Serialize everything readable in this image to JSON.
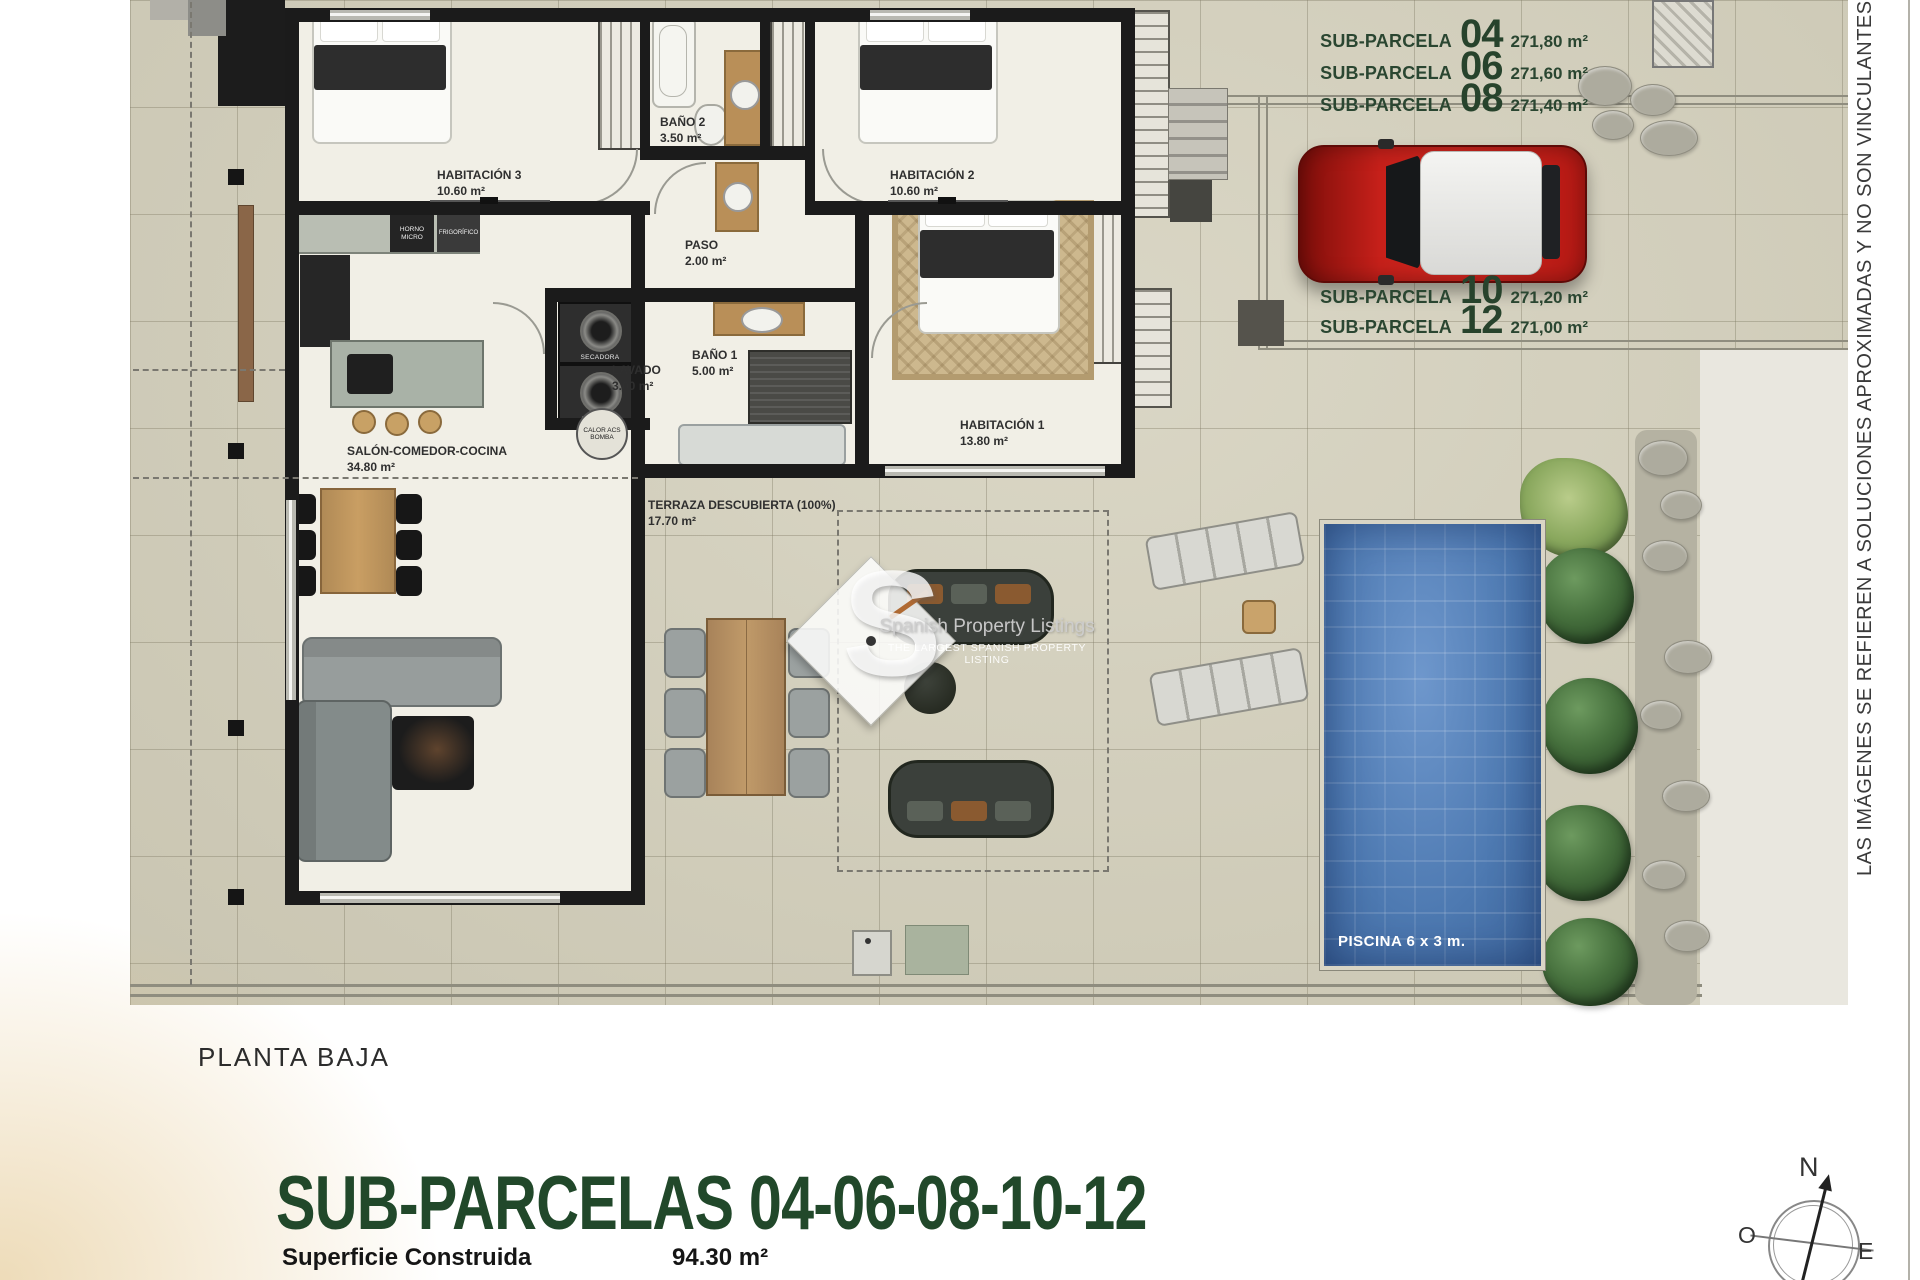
{
  "plan": {
    "rooms": [
      {
        "name": "HABITACIÓN 3",
        "area": "10.60 m²"
      },
      {
        "name": "BAÑO 2",
        "area": "3.50 m²"
      },
      {
        "name": "HABITACIÓN 2",
        "area": "10.60 m²"
      },
      {
        "name": "PASO",
        "area": "2.00 m²"
      },
      {
        "name": "LAVADO",
        "area": "3.00 m²"
      },
      {
        "name": "BAÑO 1",
        "area": "5.00 m²"
      },
      {
        "name": "HABITACIÓN 1",
        "area": "13.80 m²"
      },
      {
        "name": "SALÓN-COMEDOR-COCINA",
        "area": "34.80 m²"
      },
      {
        "name": "TERRAZA DESCUBIERTA (100%)",
        "area": "17.70 m²"
      }
    ],
    "appliances": {
      "horno_micro": "HORNO MICRO",
      "frigorifico": "FRIGORÍFICO",
      "secadora": "SECADORA",
      "lavadora": "LAVADORA",
      "caldera": "CALOR ACS BOMBA"
    },
    "pool_label": "PISCINA 6 x 3 m."
  },
  "sub_parcelas": {
    "top": [
      {
        "label": "SUB-PARCELA",
        "number": "04",
        "area": "271,80 m²"
      },
      {
        "label": "SUB-PARCELA",
        "number": "06",
        "area": "271,60 m²"
      },
      {
        "label": "SUB-PARCELA",
        "number": "08",
        "area": "271,40 m²"
      }
    ],
    "bottom": [
      {
        "label": "SUB-PARCELA",
        "number": "10",
        "area": "271,20 m²"
      },
      {
        "label": "SUB-PARCELA",
        "number": "12",
        "area": "271,00 m²"
      }
    ]
  },
  "footer": {
    "floor_label": "PLANTA BAJA",
    "title": "SUB-PARCELAS 04-06-08-10-12",
    "surface_label": "Superficie Construida",
    "surface_value": "94.30 m²"
  },
  "disclaimer": "LAS IMÁGENES SE REFIEREN A SOLUCIONES APROXIMADAS Y NO SON VINCULANTES AL PROYECTO",
  "watermark": {
    "letter": "S",
    "line1": "Spanish Property Listings",
    "line2": "THE LARGEST SPANISH PROPERTY LISTING"
  },
  "compass": {
    "north": "N",
    "west": "O",
    "east": "E"
  },
  "colors": {
    "accent_green": "#2a4631",
    "title_green": "#21482a",
    "pool_blue": "#5d89c1",
    "car_red": "#c41e18"
  }
}
